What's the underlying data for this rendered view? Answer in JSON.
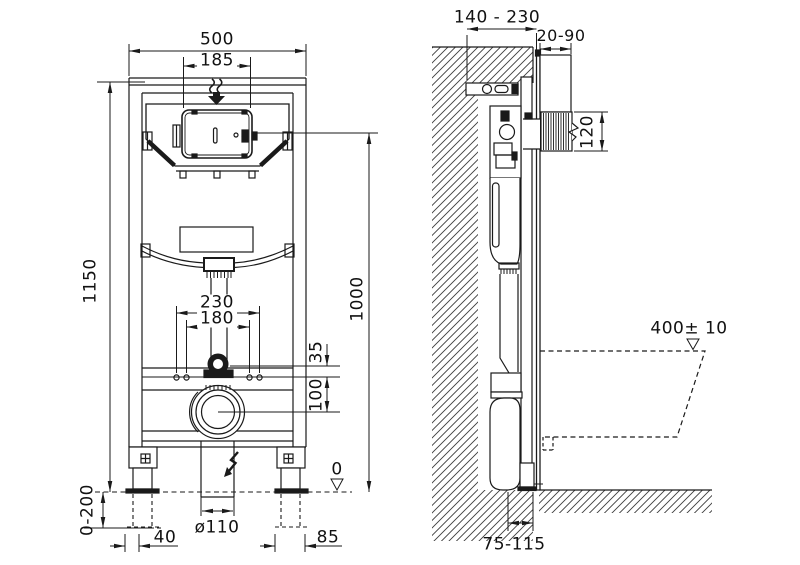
{
  "drawing": {
    "type": "technical installation drawing, wall-hung WC mounting frame, front and side view",
    "colors": {
      "line": "#1a1a1a",
      "background": "#ffffff"
    },
    "front_view": {
      "dimensions": {
        "frame_width": "500",
        "access_panel_width": "185",
        "frame_height": "1150",
        "cistern_panel_center_height": "1000",
        "fixing_bolt_spacing_outer": "230",
        "fixing_bolt_spacing_inner": "180",
        "inlet_to_bolt_line": "35",
        "bolt_line_to_drain": "100",
        "floor_level": "0",
        "leg_adjustment_range": "0-200",
        "drain_pipe_diameter": "ø110",
        "left_foot_offset": "40",
        "right_foot_offset": "85"
      }
    },
    "side_view": {
      "dimensions": {
        "frame_depth_range": "140 - 230",
        "plate_projection_range": "20-90",
        "flush_unit_height": "120",
        "bowl_rim_height": "400± 10",
        "outlet_floor_offset": "75-115"
      }
    }
  }
}
